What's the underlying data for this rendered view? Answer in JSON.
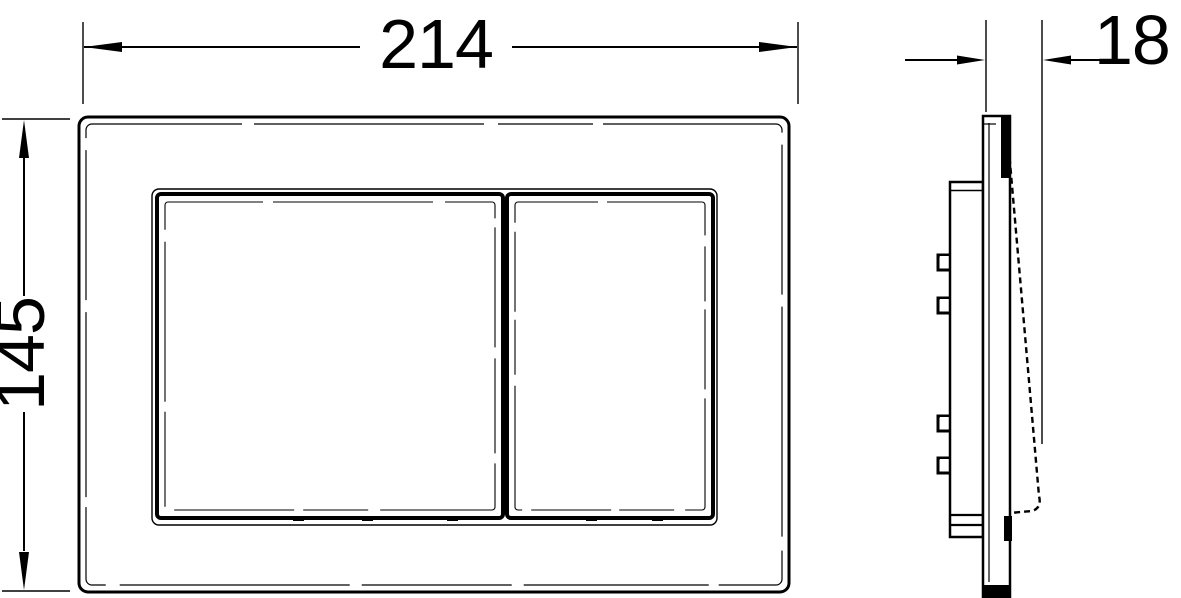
{
  "colors": {
    "background": "#ffffff",
    "line": "#000000"
  },
  "dimensions": {
    "width_label": "214",
    "height_label": "145",
    "depth_label": "18"
  }
}
